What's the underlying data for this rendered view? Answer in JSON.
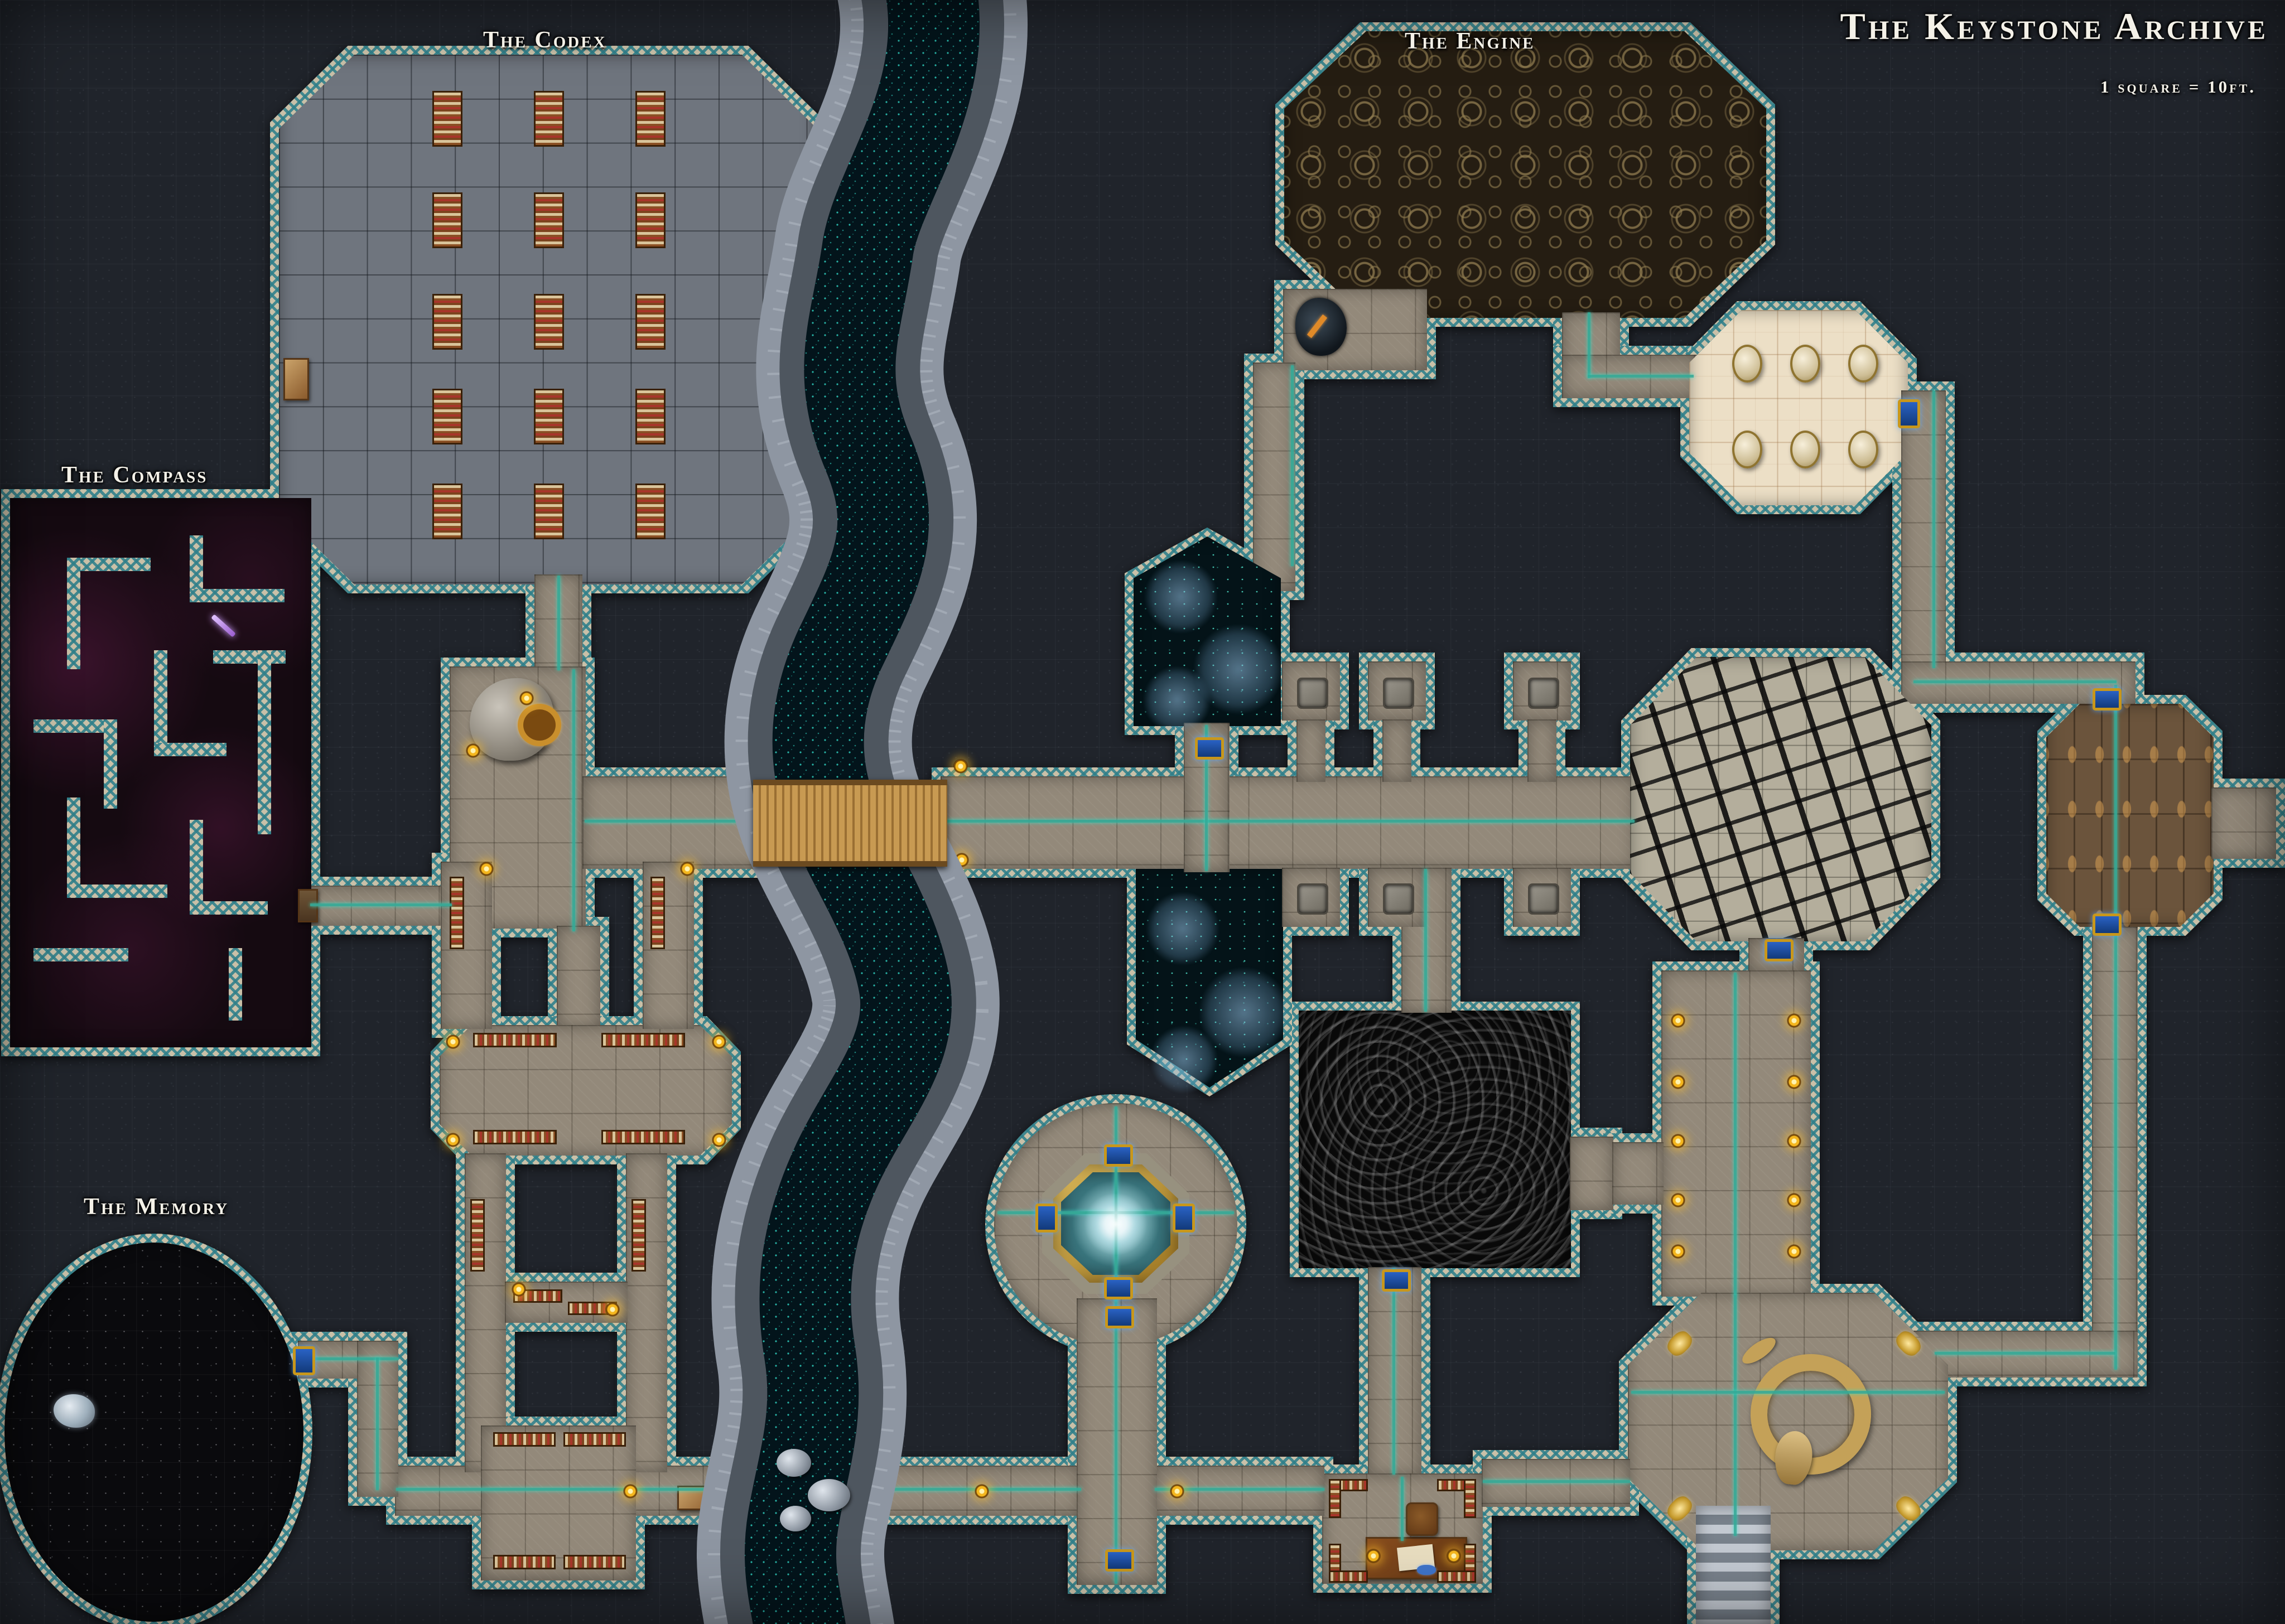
{
  "map": {
    "title": "The Keystone Archive",
    "scale_note": "1 square = 10ft.",
    "room_labels": [
      {
        "id": "codex",
        "label": "The Codex"
      },
      {
        "id": "engine",
        "label": "The Engine"
      },
      {
        "id": "compass",
        "label": "The Compass"
      },
      {
        "id": "memory",
        "label": "The Memory"
      }
    ]
  },
  "palette": {
    "bg": "#20242b",
    "wall_stone": "#c9c0a8",
    "wall_teal": "#2f7f8a",
    "conduit": "#35ad9a",
    "conduit_glow": "#34e0c8",
    "brazier_gold": "#f4b61e",
    "rune_door_blue": "#2a62c4",
    "rune_door_gold": "#c8971c",
    "corridor_floor": "#93897a",
    "codex_floor": "#6f757e",
    "marble_floor": "#ecdfc6",
    "engine_floor": "#251d12",
    "cracked_floor": "#b4ae9c",
    "rune_room_floor": "#6b543c",
    "smoke_floor": "#090909",
    "pool_floor": "#041318",
    "pool_speckle": "#50e6cd",
    "memory_floor": "#0a0a0d",
    "maze_floor": "#150a11",
    "maze_magenta": "#96286e",
    "chasm_rock": "#8e96a2",
    "chasm_void": "#03141b",
    "chasm_glow": "#2fd0c0",
    "shelf_wood": "#6b3c19",
    "bridge_wood": "#c89a52"
  }
}
